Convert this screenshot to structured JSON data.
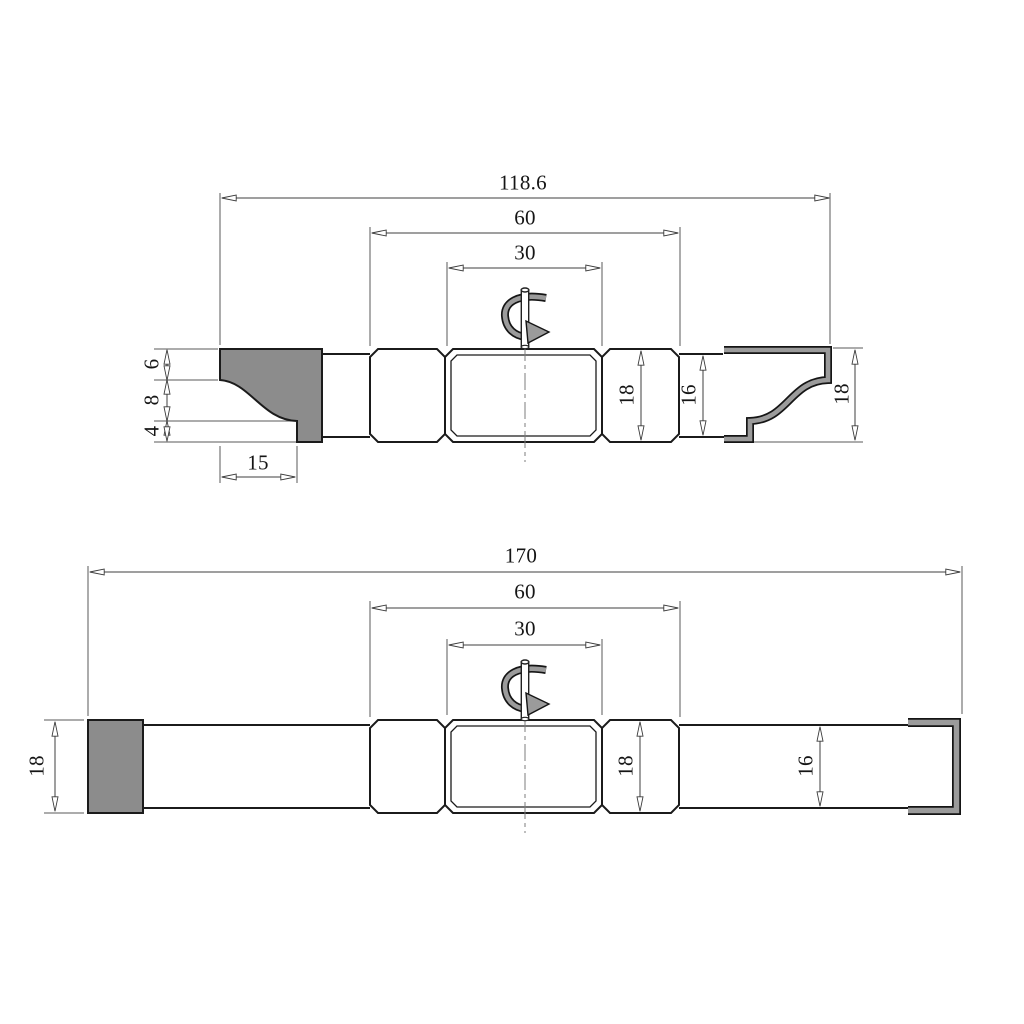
{
  "document": {
    "type": "technical-dimension-drawing",
    "background": "#ffffff"
  },
  "colors": {
    "outline": "#1b1b1b",
    "dimension_line": "#3f3f3f",
    "steel_gray_fill": "#8c8c8c",
    "rotation_arrow_gray": "#9b9b9b"
  },
  "icons": {
    "rotation_top": "rotation-direction-arrow",
    "rotation_bottom": "rotation-direction-arrow"
  },
  "top_view": {
    "dimensions": {
      "overall_length": "118.6",
      "hub_span": "60",
      "center_hub_width": "30",
      "knife_seg_top": "6",
      "knife_seg_middle": "8",
      "knife_seg_bottom": "4",
      "knife_width": "15",
      "hub_height": "18",
      "shaft_height": "16",
      "counter_profile_height": "18"
    }
  },
  "bottom_view": {
    "dimensions": {
      "overall_length": "170",
      "hub_span": "60",
      "center_hub_width": "30",
      "block_height": "18",
      "hub_height": "18",
      "shaft_height": "16"
    }
  }
}
